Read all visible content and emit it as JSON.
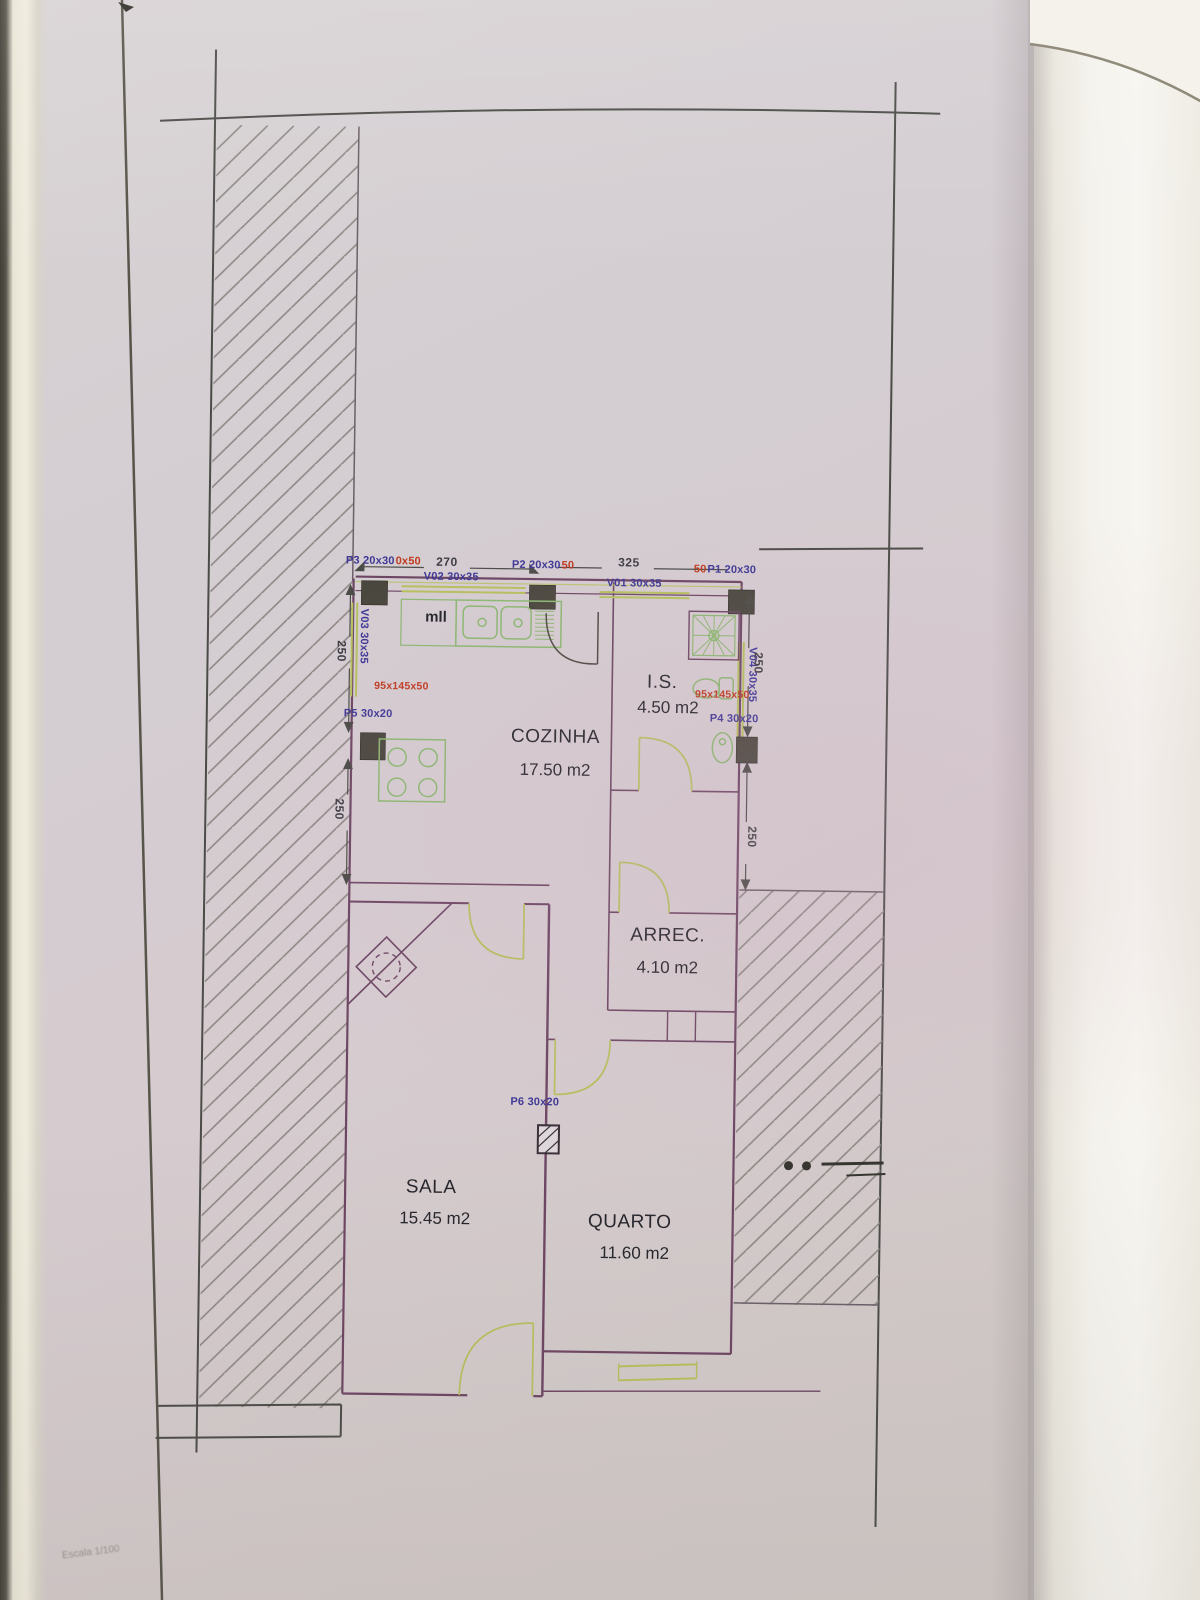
{
  "sheet": {
    "scale_label": "Escala 1/100",
    "kitchen_note": "mll",
    "rooms": [
      {
        "name": "COZINHA",
        "area": "17.50 m2"
      },
      {
        "name": "I.S.",
        "area": "4.50 m2"
      },
      {
        "name": "ARREC.",
        "area": "4.10 m2"
      },
      {
        "name": "SALA",
        "area": "15.45 m2"
      },
      {
        "name": "QUARTO",
        "area": "11.60 m2"
      }
    ],
    "windows": [
      {
        "label": "V01 30x35"
      },
      {
        "label": "V02 30x35"
      },
      {
        "label": "V03 30x35"
      },
      {
        "label": "V04 30x35"
      }
    ],
    "pillars": [
      {
        "label": "P1 20x30"
      },
      {
        "label": "P2 20x30"
      },
      {
        "label": "P3 20x30"
      },
      {
        "label": "P4 30x20"
      },
      {
        "label": "P5 30x20"
      },
      {
        "label": "P6 30x20"
      }
    ],
    "red_annotations": {
      "after_p3": "0x50",
      "after_p2": "50",
      "before_p1": "50",
      "kitchen_counter": "95x145x50",
      "bathroom_counter": "95x145x50"
    },
    "dimensions": {
      "top_left_width": "270",
      "top_right_width": "325",
      "left_upper": "250",
      "left_lower": "250",
      "right_upper": "250",
      "right_lower": "250"
    }
  },
  "colors": {
    "wall_line": "#6d4663",
    "fixture_green": "#8cb872",
    "door_green": "#b6c05e",
    "label_blue": "#3e3796",
    "annotation_red": "#c03a1f",
    "paper": "#d3ccd1",
    "pillar_fill": "#4a473e"
  }
}
